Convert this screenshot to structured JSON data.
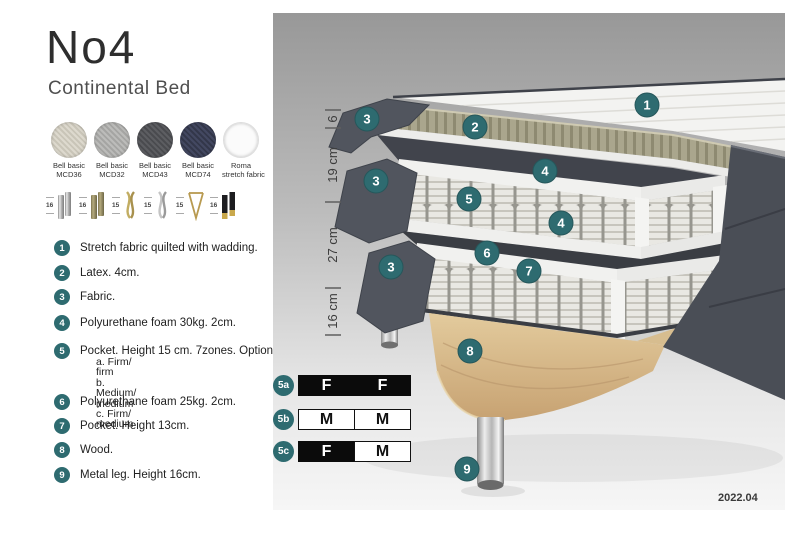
{
  "colors": {
    "accent_teal": "#2e6b70",
    "fabric_dark_gray": "#4d515a",
    "latex_olive": "#aaa68d",
    "wood": "#dcc294",
    "panel_gray_top": "#989898",
    "panel_gray_bottom": "#f6f6f6"
  },
  "header": {
    "title": "No4",
    "subtitle": "Continental Bed"
  },
  "swatches": [
    {
      "line1": "Bell basic",
      "line2": "MCD36",
      "color": "#d8d4c9"
    },
    {
      "line1": "Bell basic",
      "line2": "MCD32",
      "color": "#b3b3b1"
    },
    {
      "line1": "Bell basic",
      "line2": "MCD43",
      "color": "#55565a"
    },
    {
      "line1": "Bell basic",
      "line2": "MCD74",
      "color": "#3a3e52"
    },
    {
      "line1": "Roma",
      "line2": "stretch fabric",
      "color": "#fafafa"
    }
  ],
  "legs": [
    {
      "height": "16",
      "finish": "chrome-cylinder"
    },
    {
      "height": "16",
      "finish": "brass-cylinder"
    },
    {
      "height": "15",
      "finish": "gold-twist"
    },
    {
      "height": "15",
      "finish": "silver-twist"
    },
    {
      "height": "15",
      "finish": "gold-hairpin"
    },
    {
      "height": "16",
      "finish": "black-gold-cylinder"
    }
  ],
  "materials": [
    {
      "num": "1",
      "text": "Stretch fabric quilted with wadding."
    },
    {
      "num": "2",
      "text": "Latex. 4cm."
    },
    {
      "num": "3",
      "text": "Fabric."
    },
    {
      "num": "4",
      "text": "Polyurethane foam 30kg. 2cm."
    },
    {
      "num": "5",
      "text": "Pocket. Height 15 cm. 7zones. Option:",
      "options": [
        "a. Firm/ firm",
        "b. Medium/ medium",
        "c. Firm/ medium"
      ]
    },
    {
      "num": "6",
      "text": "Polyurethane foam 25kg. 2cm."
    },
    {
      "num": "7",
      "text": "Pocket. Height 13cm."
    },
    {
      "num": "8",
      "text": "Wood."
    },
    {
      "num": "9",
      "text": "Metal leg. Height 16cm."
    }
  ],
  "diagram": {
    "measurements": [
      "6",
      "19 cm",
      "27 cm",
      "16 cm"
    ],
    "badges": [
      "1",
      "2",
      "3",
      "4",
      "3",
      "5",
      "4",
      "6",
      "7",
      "3",
      "8",
      "9"
    ]
  },
  "firmness": [
    {
      "label": "5a",
      "cells": [
        "F",
        "F"
      ]
    },
    {
      "label": "5b",
      "cells": [
        "M",
        "M"
      ]
    },
    {
      "label": "5c",
      "cells": [
        "F",
        "M"
      ]
    }
  ],
  "footer": {
    "version": "2022.04"
  }
}
